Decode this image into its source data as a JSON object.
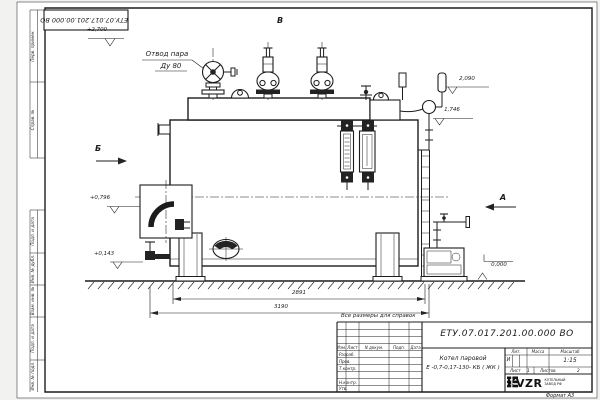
{
  "frame": {
    "top_stamp": "ЕТУ.07.017.201.00.000  ВО",
    "format_note": "Формат А3",
    "margin_labels": [
      {
        "label": "Перв. примен."
      },
      {
        "label": "Справ. №"
      },
      {
        "label": "Подп. и дата"
      },
      {
        "label": "Инв. № дубл."
      },
      {
        "label": "Взам. инв. №"
      },
      {
        "label": "Подп. и дата"
      },
      {
        "label": "Инв. № подл."
      }
    ]
  },
  "drawing": {
    "callouts": {
      "steam_outlet_line1": "Отвод пара",
      "steam_outlet_line2": "Ду 80"
    },
    "view_markers": {
      "top": "В",
      "left": "Б",
      "right": "А"
    },
    "levels": {
      "l2700": "+2,700",
      "l2090": "2,090",
      "l1746": "1,746",
      "l0796": "+0,796",
      "l0143": "+0,143",
      "l0000": "0,000"
    },
    "dimensions": {
      "d2891": "2891",
      "d3190": "3190"
    },
    "note": "Все размеры для справок"
  },
  "title_block": {
    "doc_number": "ЕТУ.07.017.201.00.000  ВО",
    "title_line1": "Котел паровой",
    "title_line2": "Е -0,7-0,17-130- КБ ( ЖК )",
    "cols": {
      "izm": "Изм.",
      "list": "Лист",
      "doc": "N докум.",
      "podp": "Подп.",
      "data": "Дата"
    },
    "rows": {
      "razrab": "Разраб.",
      "prov": "Пров.",
      "tkontr": "Т.контр.",
      "nkontr": "Н.контр.",
      "utv": "Утв."
    },
    "lit_header": "Лит.",
    "mass_header": "Масса",
    "scale_header": "Масштаб",
    "lit_value": "И",
    "scale_value": "1:15",
    "sheet_label": "Лист",
    "sheet_num": "1",
    "sheets_label": "Листов",
    "sheets_num": "2",
    "logo": {
      "text": "KVZR",
      "sub1": "КОТЕЛЬНЫЙ",
      "sub2": "ЗАВОД РФ"
    }
  },
  "colors": {
    "ink": "#1c1c1c",
    "paper": "#ffffff"
  }
}
